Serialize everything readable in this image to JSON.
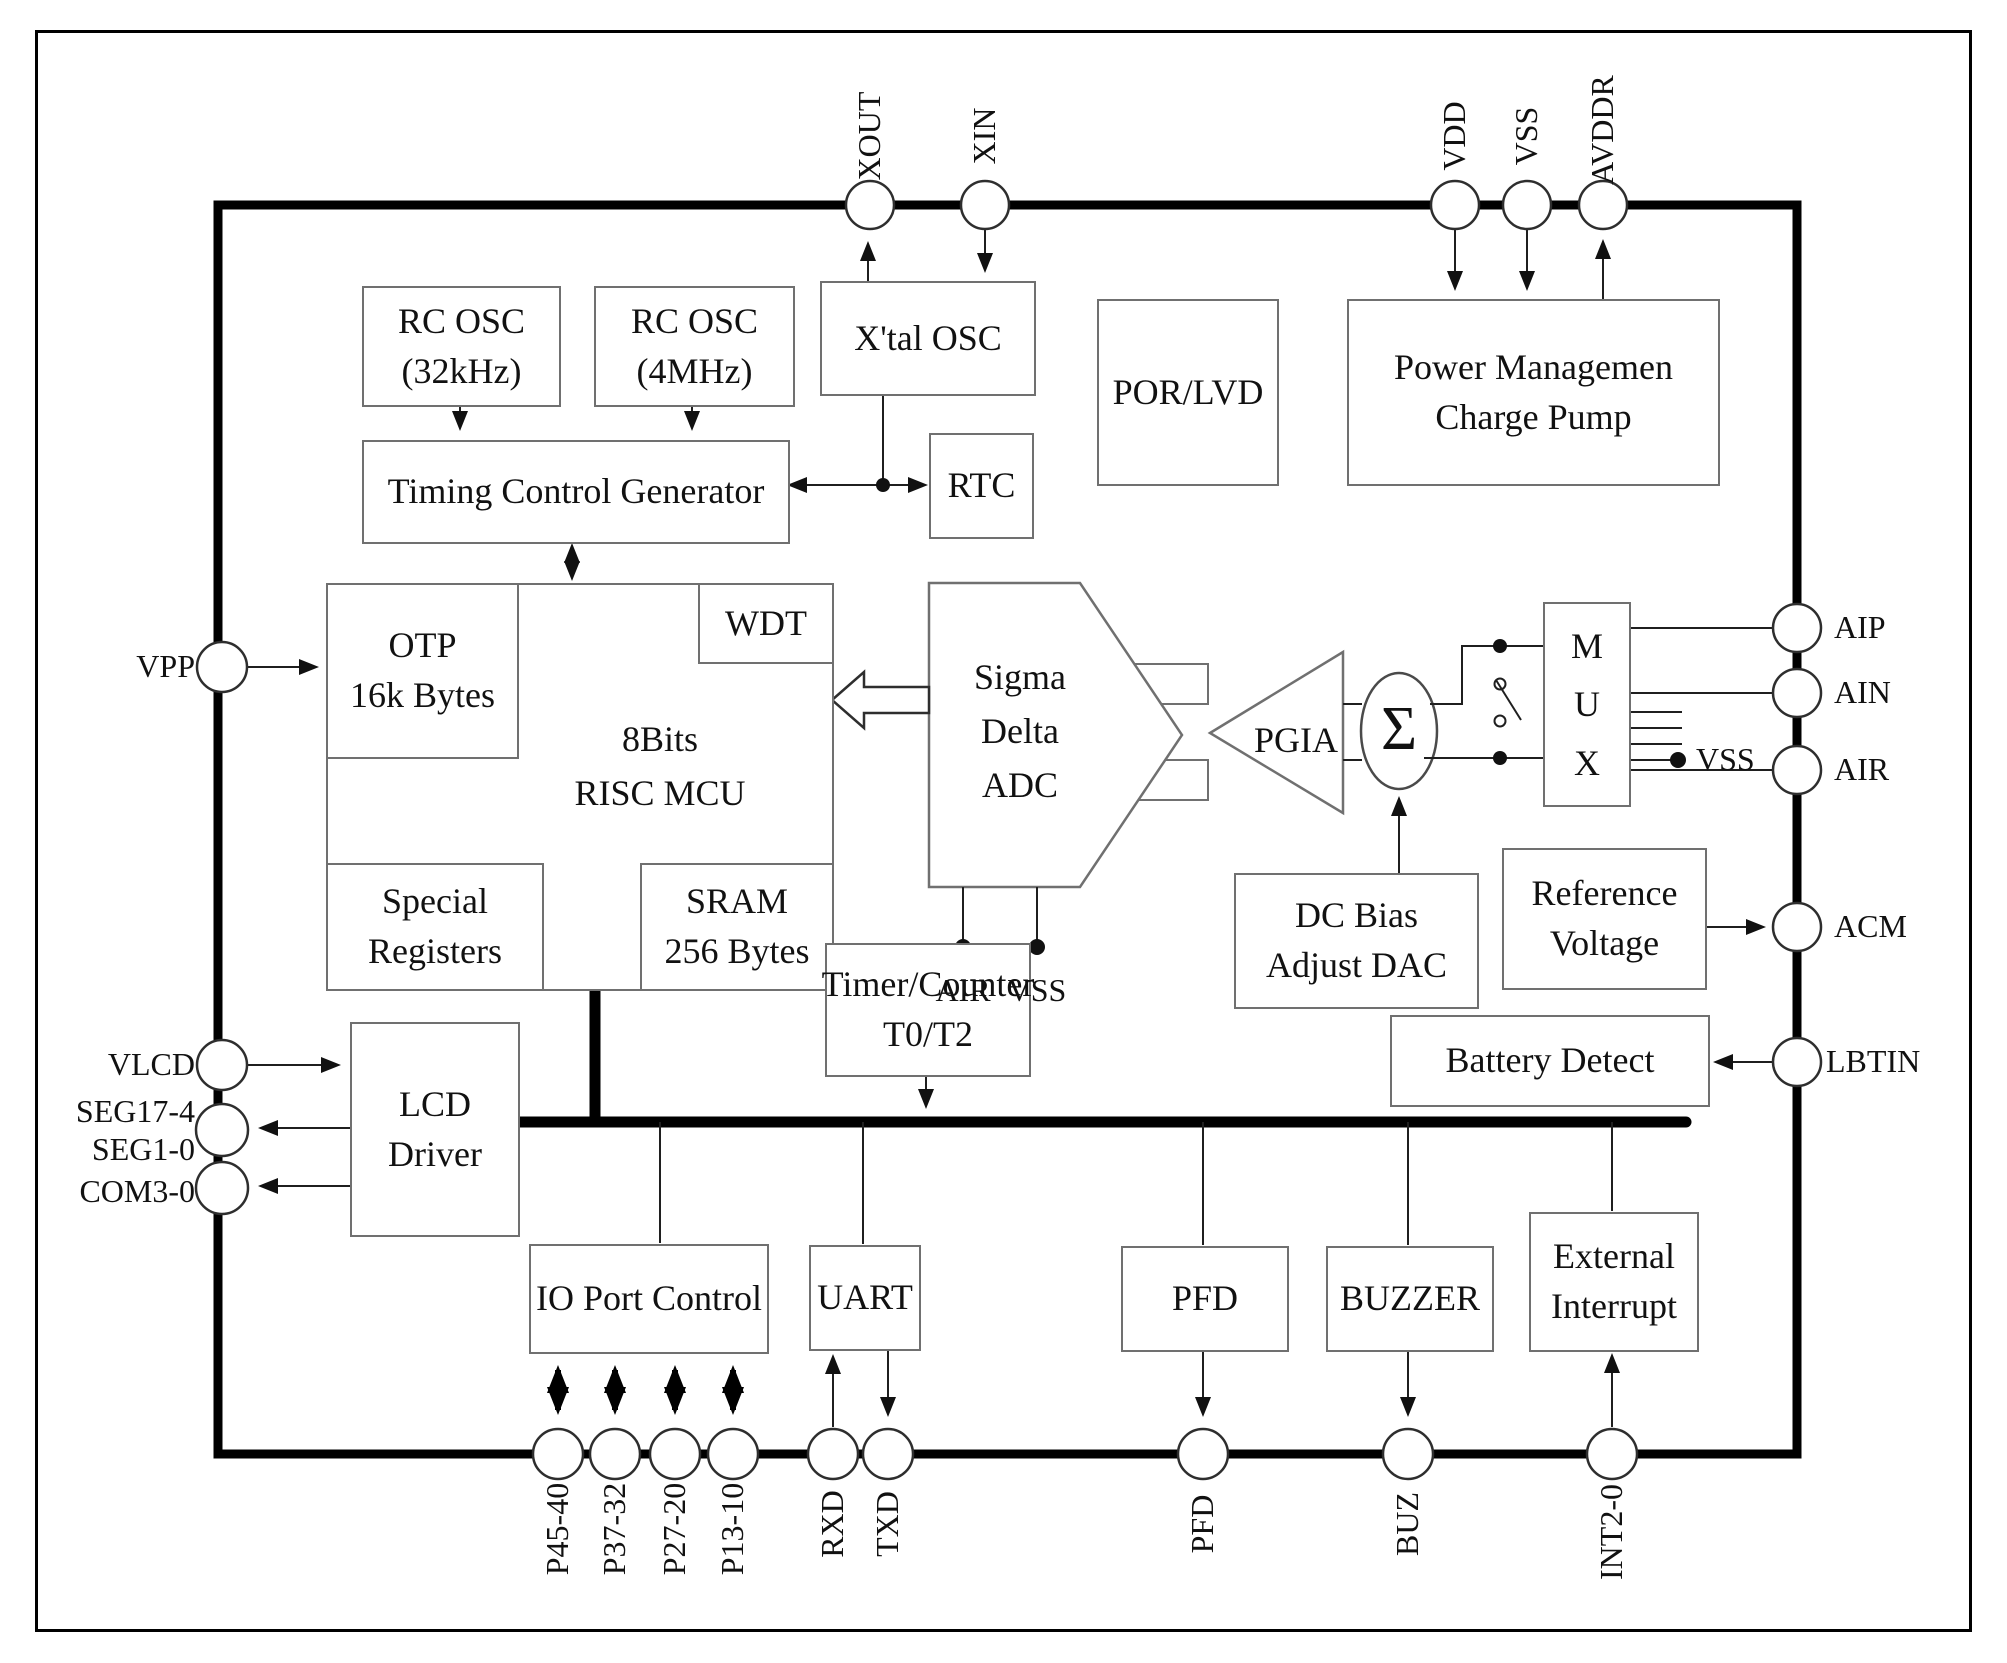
{
  "blocks": {
    "rc_osc_32k": {
      "l1": "RC OSC",
      "l2": "(32kHz)"
    },
    "rc_osc_4m": {
      "l1": "RC OSC",
      "l2": "(4MHz)"
    },
    "xtal_osc": {
      "l1": "X'tal OSC"
    },
    "por_lvd": {
      "l1": "POR/LVD"
    },
    "power_mgmt": {
      "l1": "Power Managemen",
      "l2": "Charge Pump"
    },
    "timing": {
      "l1": "Timing Control Generator"
    },
    "rtc": {
      "l1": "RTC"
    },
    "wdt": {
      "l1": "WDT"
    },
    "otp": {
      "l1": "OTP",
      "l2": "16k Bytes"
    },
    "mcu": {
      "l1": "8Bits",
      "l2": "RISC  MCU"
    },
    "special_registers": {
      "l1": "Special",
      "l2": "Registers"
    },
    "sram": {
      "l1": "SRAM",
      "l2": "256 Bytes"
    },
    "sigma_delta_adc": {
      "l1": "Sigma",
      "l2": "Delta",
      "l3": "ADC"
    },
    "pgia": {
      "l1": "PGIA"
    },
    "summer": {
      "symbol": "Σ"
    },
    "dc_bias": {
      "l1": "DC Bias",
      "l2": "Adjust DAC"
    },
    "mux": {
      "l1": "M",
      "l2": "U",
      "l3": "X"
    },
    "reference_voltage": {
      "l1": "Reference",
      "l2": "Voltage"
    },
    "battery_detect": {
      "l1": "Battery Detect"
    },
    "timer_counter": {
      "l1": "Timer/Counter",
      "l2": "T0/T2"
    },
    "lcd_driver": {
      "l1": "LCD",
      "l2": "Driver"
    },
    "io_port": {
      "l1": "IO Port Control"
    },
    "uart": {
      "l1": "UART"
    },
    "pfd": {
      "l1": "PFD"
    },
    "buzzer": {
      "l1": "BUZZER"
    },
    "ext_int": {
      "l1": "External",
      "l2": "Interrupt"
    }
  },
  "pins": {
    "top": [
      "XOUT",
      "XIN",
      "VDD",
      "VSS",
      "AVDDR"
    ],
    "bottom": [
      "P45-40",
      "P37-32",
      "P27-20",
      "P13-10",
      "RXD",
      "TXD",
      "PFD",
      "BUZ",
      "INT2-0"
    ],
    "left": {
      "vpp": "VPP",
      "vlcd": "VLCD",
      "seg_hi": "SEG17-4",
      "seg_lo": "SEG1-0",
      "com": "COM3-0"
    },
    "right": {
      "aip": "AIP",
      "ain": "AIN",
      "air": "AIR",
      "acm": "ACM",
      "lbtin": "LBTIN"
    },
    "internal": {
      "adc_air": "AIR",
      "adc_vss": "VSS",
      "mux_vss": "VSS"
    }
  },
  "colors": {
    "wire": "#1f1f1f",
    "box_border": "#707070",
    "thick_line": "#000000",
    "background": "#ffffff"
  }
}
